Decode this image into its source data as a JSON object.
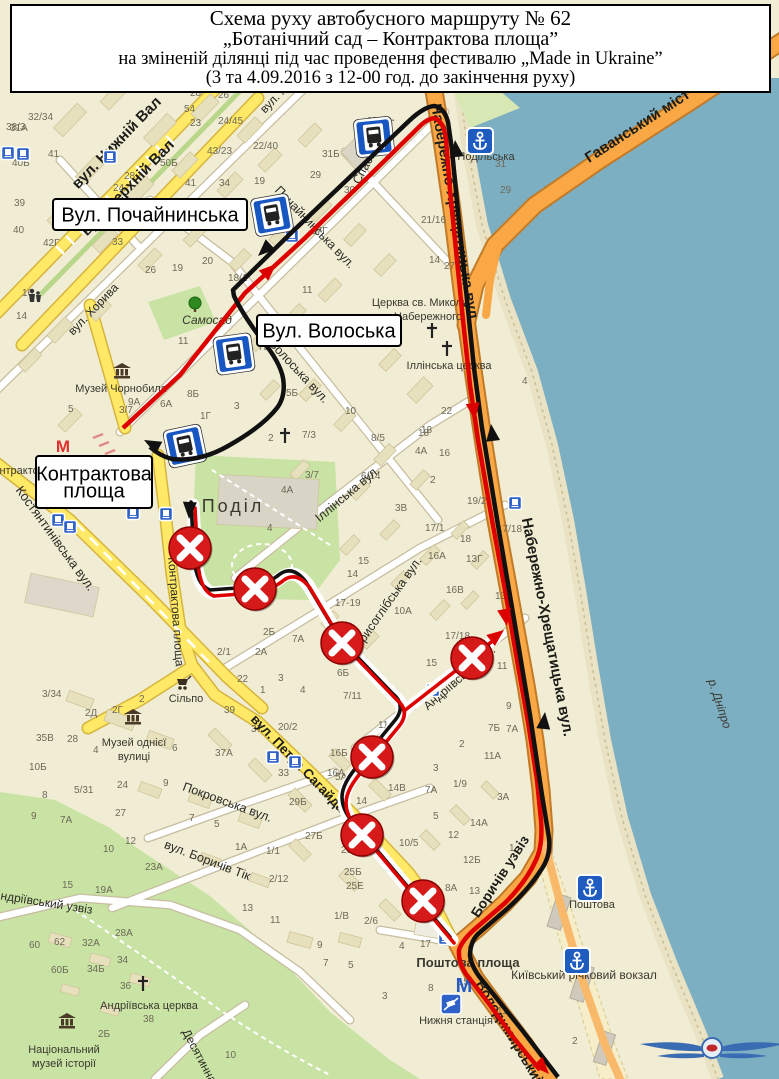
{
  "title": {
    "line1": "Схема руху автобусного маршруту № 62",
    "line2": "„Ботанічний сад – Контрактова площа”",
    "line3": "на зміненій ділянці під час проведення фестивалю „Made in Ukraine”",
    "line4": "(3 та 4.09.2016 з 12-00 год. до закінчення руху)"
  },
  "colors": {
    "land": "#f1edd4",
    "water": "#7dafc3",
    "quay": "#e9e2c4",
    "road_orange": "#f9a845",
    "road_orange_casing": "#c07a28",
    "road_yellow": "#ffe967",
    "road_yellow_casing": "#d5b43c",
    "road_white": "#ffffff",
    "road_white_casing": "#c6bd9f",
    "park": "#c9e3a4",
    "building": "#e7e0bd",
    "building_stroke": "#d0c59c",
    "route_red": "#dd0000",
    "route_black": "#111111",
    "sign_red": "#d61a1a",
    "stop_blue": "#1857c2",
    "blue_text": "#2a56ae"
  },
  "callouts": [
    {
      "id": "pochaininska",
      "x": 53,
      "y": 199,
      "w": 194,
      "h": 31,
      "lines": [
        "Вул. Почайнинська"
      ],
      "fs": 20
    },
    {
      "id": "voloska",
      "x": 257,
      "y": 315,
      "w": 144,
      "h": 31,
      "lines": [
        "Вул. Волоська"
      ],
      "fs": 20
    },
    {
      "id": "kontraktova",
      "x": 36,
      "y": 456,
      "w": 116,
      "h": 52,
      "lines": [
        "Контрактова",
        "площа"
      ],
      "fs": 20
    }
  ],
  "street_labels": [
    {
      "t": "вул. Нижній Вал",
      "x": 120,
      "y": 146,
      "r": -46,
      "s": 15,
      "b": 1
    },
    {
      "t": "вул. Верхній Вал",
      "x": 131,
      "y": 191,
      "r": -46,
      "s": 15,
      "b": 1
    },
    {
      "t": "вул. Хорива",
      "x": 96,
      "y": 312,
      "r": -46,
      "s": 12,
      "b": 0
    },
    {
      "t": "вул. Хорива",
      "x": 288,
      "y": 90,
      "r": -46,
      "s": 12,
      "b": 0
    },
    {
      "t": "Почайнинська вул.",
      "x": 312,
      "y": 230,
      "r": 46,
      "s": 12.5,
      "b": 0
    },
    {
      "t": "Спаська вул.",
      "x": 377,
      "y": 152,
      "r": -62,
      "s": 12.5,
      "b": 0
    },
    {
      "t": "Волоська вул.",
      "x": 296,
      "y": 374,
      "r": 47,
      "s": 12.5,
      "b": 0
    },
    {
      "t": "Костянтинівська вул.",
      "x": 52,
      "y": 541,
      "r": 54,
      "s": 13,
      "b": 0
    },
    {
      "t": "Іллінська вул.",
      "x": 350,
      "y": 497,
      "r": -40,
      "s": 12.5,
      "b": 0
    },
    {
      "t": "Борисоглібська вул.",
      "x": 389,
      "y": 608,
      "r": -55,
      "s": 12.5,
      "b": 0
    },
    {
      "t": "Андріївська вул.",
      "x": 462,
      "y": 681,
      "r": -41,
      "s": 12,
      "b": 0
    },
    {
      "t": "вул. Петра Сагайдачного",
      "x": 308,
      "y": 780,
      "r": 46,
      "s": 13.5,
      "b": 1
    },
    {
      "t": "Покровська вул.",
      "x": 226,
      "y": 806,
      "r": 20,
      "s": 12.5,
      "b": 0
    },
    {
      "t": "вул. Боричів Тік",
      "x": 206,
      "y": 864,
      "r": 21,
      "s": 12.5,
      "b": 0
    },
    {
      "t": "Андріївський узвіз",
      "x": 42,
      "y": 906,
      "r": 9,
      "s": 12,
      "b": 0
    },
    {
      "t": "Десятинна",
      "x": 196,
      "y": 1058,
      "r": 62,
      "s": 12,
      "b": 0
    },
    {
      "t": "Контрактова площа",
      "x": 172,
      "y": 612,
      "r": 86,
      "s": 12,
      "b": 0
    },
    {
      "t": "Набережно-Хрещатицька вул",
      "x": 450,
      "y": 212,
      "r": 80,
      "s": 15,
      "b": 1
    },
    {
      "t": "Набережно-Хрещатицька вул.",
      "x": 543,
      "y": 628,
      "r": 79,
      "s": 15,
      "b": 1
    },
    {
      "t": "Гаванський міст",
      "x": 640,
      "y": 130,
      "r": -33,
      "s": 15,
      "b": 1
    },
    {
      "t": "Боричів узвіз",
      "x": 504,
      "y": 879,
      "r": -57,
      "s": 14,
      "b": 1
    },
    {
      "t": "Володимирський узвіз",
      "x": 516,
      "y": 1052,
      "r": 59,
      "s": 14,
      "b": 1
    }
  ],
  "poi_labels": [
    {
      "t": "Музей Чорнобиля",
      "x": 121,
      "y": 392,
      "s": 11
    },
    {
      "t": "Самосад",
      "x": 207,
      "y": 324,
      "s": 12,
      "c": "#4f8f3f",
      "i": 1
    },
    {
      "t": "Поділ",
      "x": 233,
      "y": 512,
      "s": 18,
      "c": "#96927e",
      "ls": 3
    },
    {
      "t": "Церква св. Миколи",
      "x": 420,
      "y": 306,
      "s": 11
    },
    {
      "t": "Набережного",
      "x": 428,
      "y": 320,
      "s": 11
    },
    {
      "t": "Іллінська церква",
      "x": 449,
      "y": 369,
      "s": 11
    },
    {
      "t": "Музей однієї",
      "x": 134,
      "y": 746,
      "s": 11
    },
    {
      "t": "вулиці",
      "x": 134,
      "y": 760,
      "s": 11
    },
    {
      "t": "Сільпо",
      "x": 186,
      "y": 702,
      "s": 11
    },
    {
      "t": "Контрактова пл.",
      "x": 28,
      "y": 474,
      "s": 11,
      "c": "#55524a"
    },
    {
      "t": "Поштова площа",
      "x": 468,
      "y": 967,
      "s": 13,
      "b": 1
    },
    {
      "t": "Київський річковий вокзал",
      "x": 584,
      "y": 979,
      "s": 12,
      "c": "#2a56ae"
    },
    {
      "t": "Нижня станція",
      "x": 456,
      "y": 1024,
      "s": 11,
      "c": "#2a56ae"
    },
    {
      "t": "Поштова",
      "x": 592,
      "y": 908,
      "s": 11,
      "c": "#2a56ae"
    },
    {
      "t": "Подільська",
      "x": 486,
      "y": 160,
      "s": 11,
      "c": "#2a56ae"
    },
    {
      "t": "Андріївська церква",
      "x": 149,
      "y": 1009,
      "s": 11
    },
    {
      "t": "Національний",
      "x": 64,
      "y": 1053,
      "s": 11
    },
    {
      "t": "музей історії",
      "x": 64,
      "y": 1067,
      "s": 11
    },
    {
      "t": "р. Дніпро",
      "x": 716,
      "y": 705,
      "s": 12,
      "c": "#3b6fb4",
      "i": 1,
      "r": 72
    }
  ],
  "house_numbers": [
    {
      "x": 6,
      "y": 130,
      "t": "38/3"
    },
    {
      "x": 28,
      "y": 120,
      "t": "32/34"
    },
    {
      "x": 107,
      "y": 90,
      "t": "49"
    },
    {
      "x": 190,
      "y": 96,
      "t": "28"
    },
    {
      "x": 218,
      "y": 98,
      "t": "26"
    },
    {
      "x": 352,
      "y": 93,
      "t": "35А"
    },
    {
      "x": 10,
      "y": 131,
      "t": "31А"
    },
    {
      "x": 184,
      "y": 112,
      "t": "54"
    },
    {
      "x": 190,
      "y": 126,
      "t": "23"
    },
    {
      "x": 218,
      "y": 124,
      "t": "24/45"
    },
    {
      "x": 367,
      "y": 124,
      "t": "37"
    },
    {
      "x": 48,
      "y": 157,
      "t": "41"
    },
    {
      "x": 12,
      "y": 166,
      "t": "40Б"
    },
    {
      "x": 160,
      "y": 166,
      "t": "50Б"
    },
    {
      "x": 207,
      "y": 154,
      "t": "43/23"
    },
    {
      "x": 253,
      "y": 149,
      "t": "22/40"
    },
    {
      "x": 322,
      "y": 157,
      "t": "31Б"
    },
    {
      "x": 124,
      "y": 179,
      "t": "28"
    },
    {
      "x": 113,
      "y": 191,
      "t": "24"
    },
    {
      "x": 185,
      "y": 186,
      "t": "41"
    },
    {
      "x": 219,
      "y": 186,
      "t": "34"
    },
    {
      "x": 254,
      "y": 184,
      "t": "19"
    },
    {
      "x": 14,
      "y": 206,
      "t": "39"
    },
    {
      "x": 310,
      "y": 178,
      "t": "29"
    },
    {
      "x": 344,
      "y": 193,
      "t": "30"
    },
    {
      "x": 13,
      "y": 233,
      "t": "40"
    },
    {
      "x": 43,
      "y": 246,
      "t": "42Г"
    },
    {
      "x": 22,
      "y": 296,
      "t": "16"
    },
    {
      "x": 16,
      "y": 319,
      "t": "14"
    },
    {
      "x": 145,
      "y": 273,
      "t": "26"
    },
    {
      "x": 172,
      "y": 271,
      "t": "19"
    },
    {
      "x": 202,
      "y": 264,
      "t": "20"
    },
    {
      "x": 112,
      "y": 245,
      "t": "33"
    },
    {
      "x": 228,
      "y": 281,
      "t": "18/1"
    },
    {
      "x": 311,
      "y": 234,
      "t": "17Г"
    },
    {
      "x": 302,
      "y": 293,
      "t": "11"
    },
    {
      "x": 217,
      "y": 352,
      "t": "12"
    },
    {
      "x": 178,
      "y": 344,
      "t": "11"
    },
    {
      "x": 215,
      "y": 371,
      "t": "10"
    },
    {
      "x": 258,
      "y": 350,
      "t": "7Б"
    },
    {
      "x": 286,
      "y": 396,
      "t": "5Б"
    },
    {
      "x": 234,
      "y": 409,
      "t": "3"
    },
    {
      "x": 128,
      "y": 405,
      "t": "9А"
    },
    {
      "x": 187,
      "y": 397,
      "t": "8Б"
    },
    {
      "x": 160,
      "y": 407,
      "t": "6А"
    },
    {
      "x": 200,
      "y": 419,
      "t": "1Г"
    },
    {
      "x": 119,
      "y": 413,
      "t": "3/7"
    },
    {
      "x": 68,
      "y": 412,
      "t": "5"
    },
    {
      "x": 302,
      "y": 438,
      "t": "7/3"
    },
    {
      "x": 268,
      "y": 441,
      "t": "2"
    },
    {
      "x": 371,
      "y": 441,
      "t": "8/5"
    },
    {
      "x": 345,
      "y": 414,
      "t": "10"
    },
    {
      "x": 305,
      "y": 478,
      "t": "3/7"
    },
    {
      "x": 281,
      "y": 493,
      "t": "4А"
    },
    {
      "x": 267,
      "y": 531,
      "t": "4"
    },
    {
      "x": 361,
      "y": 479,
      "t": "6/14"
    },
    {
      "x": 421,
      "y": 433,
      "t": "18"
    },
    {
      "x": 415,
      "y": 454,
      "t": "4А"
    },
    {
      "x": 439,
      "y": 456,
      "t": "16"
    },
    {
      "x": 430,
      "y": 483,
      "t": "2"
    },
    {
      "x": 395,
      "y": 511,
      "t": "3В"
    },
    {
      "x": 425,
      "y": 531,
      "t": "17/1"
    },
    {
      "x": 428,
      "y": 559,
      "t": "16А"
    },
    {
      "x": 466,
      "y": 562,
      "t": "13Г"
    },
    {
      "x": 446,
      "y": 593,
      "t": "16В"
    },
    {
      "x": 495,
      "y": 599,
      "t": "13Б"
    },
    {
      "x": 467,
      "y": 504,
      "t": "19/21"
    },
    {
      "x": 497,
      "y": 532,
      "t": "17/18"
    },
    {
      "x": 460,
      "y": 542,
      "t": "18"
    },
    {
      "x": 358,
      "y": 564,
      "t": "15"
    },
    {
      "x": 347,
      "y": 577,
      "t": "14"
    },
    {
      "x": 335,
      "y": 606,
      "t": "17-19"
    },
    {
      "x": 394,
      "y": 614,
      "t": "10А"
    },
    {
      "x": 445,
      "y": 639,
      "t": "17/18"
    },
    {
      "x": 426,
      "y": 666,
      "t": "15"
    },
    {
      "x": 497,
      "y": 669,
      "t": "11"
    },
    {
      "x": 506,
      "y": 709,
      "t": "9"
    },
    {
      "x": 488,
      "y": 731,
      "t": "7Б"
    },
    {
      "x": 506,
      "y": 732,
      "t": "7А"
    },
    {
      "x": 337,
      "y": 676,
      "t": "6Б"
    },
    {
      "x": 343,
      "y": 699,
      "t": "7/11"
    },
    {
      "x": 378,
      "y": 728,
      "t": "11А"
    },
    {
      "x": 335,
      "y": 780,
      "t": "5А"
    },
    {
      "x": 388,
      "y": 791,
      "t": "14В"
    },
    {
      "x": 425,
      "y": 793,
      "t": "7А"
    },
    {
      "x": 459,
      "y": 747,
      "t": "2"
    },
    {
      "x": 484,
      "y": 759,
      "t": "11А"
    },
    {
      "x": 433,
      "y": 771,
      "t": "3"
    },
    {
      "x": 453,
      "y": 787,
      "t": "1/9"
    },
    {
      "x": 497,
      "y": 800,
      "t": "3А"
    },
    {
      "x": 433,
      "y": 819,
      "t": "5"
    },
    {
      "x": 356,
      "y": 804,
      "t": "14"
    },
    {
      "x": 348,
      "y": 822,
      "t": "10"
    },
    {
      "x": 470,
      "y": 826,
      "t": "14А"
    },
    {
      "x": 448,
      "y": 838,
      "t": "12"
    },
    {
      "x": 399,
      "y": 846,
      "t": "10/5"
    },
    {
      "x": 463,
      "y": 863,
      "t": "12Б"
    },
    {
      "x": 509,
      "y": 851,
      "t": "1"
    },
    {
      "x": 341,
      "y": 853,
      "t": "25А"
    },
    {
      "x": 344,
      "y": 875,
      "t": "25Б"
    },
    {
      "x": 346,
      "y": 889,
      "t": "25Е"
    },
    {
      "x": 407,
      "y": 911,
      "t": "23"
    },
    {
      "x": 445,
      "y": 891,
      "t": "8А"
    },
    {
      "x": 469,
      "y": 894,
      "t": "13"
    },
    {
      "x": 420,
      "y": 947,
      "t": "17"
    },
    {
      "x": 399,
      "y": 949,
      "t": "4"
    },
    {
      "x": 364,
      "y": 924,
      "t": "2/6"
    },
    {
      "x": 334,
      "y": 919,
      "t": "1/В"
    },
    {
      "x": 458,
      "y": 985,
      "t": "15"
    },
    {
      "x": 428,
      "y": 991,
      "t": "8"
    },
    {
      "x": 497,
      "y": 1014,
      "t": "11"
    },
    {
      "x": 572,
      "y": 1044,
      "t": "2"
    },
    {
      "x": 42,
      "y": 697,
      "t": "3/34"
    },
    {
      "x": 85,
      "y": 716,
      "t": "2Д"
    },
    {
      "x": 112,
      "y": 713,
      "t": "2Г"
    },
    {
      "x": 139,
      "y": 702,
      "t": "2"
    },
    {
      "x": 36,
      "y": 741,
      "t": "35В"
    },
    {
      "x": 67,
      "y": 742,
      "t": "28"
    },
    {
      "x": 93,
      "y": 753,
      "t": "4"
    },
    {
      "x": 172,
      "y": 751,
      "t": "6"
    },
    {
      "x": 215,
      "y": 756,
      "t": "37А"
    },
    {
      "x": 224,
      "y": 713,
      "t": "39"
    },
    {
      "x": 251,
      "y": 732,
      "t": "37"
    },
    {
      "x": 278,
      "y": 730,
      "t": "20/2"
    },
    {
      "x": 278,
      "y": 776,
      "t": "33"
    },
    {
      "x": 289,
      "y": 805,
      "t": "29Б"
    },
    {
      "x": 330,
      "y": 756,
      "t": "16Б"
    },
    {
      "x": 327,
      "y": 776,
      "t": "16А"
    },
    {
      "x": 305,
      "y": 839,
      "t": "27Б"
    },
    {
      "x": 29,
      "y": 770,
      "t": "10Б"
    },
    {
      "x": 42,
      "y": 798,
      "t": "8"
    },
    {
      "x": 74,
      "y": 793,
      "t": "5/31"
    },
    {
      "x": 117,
      "y": 788,
      "t": "24"
    },
    {
      "x": 163,
      "y": 786,
      "t": "9"
    },
    {
      "x": 115,
      "y": 816,
      "t": "27"
    },
    {
      "x": 125,
      "y": 844,
      "t": "12"
    },
    {
      "x": 103,
      "y": 852,
      "t": "10"
    },
    {
      "x": 60,
      "y": 823,
      "t": "7А"
    },
    {
      "x": 31,
      "y": 819,
      "t": "9"
    },
    {
      "x": 145,
      "y": 870,
      "t": "23А"
    },
    {
      "x": 189,
      "y": 821,
      "t": "7"
    },
    {
      "x": 214,
      "y": 827,
      "t": "5"
    },
    {
      "x": 235,
      "y": 850,
      "t": "1А"
    },
    {
      "x": 266,
      "y": 854,
      "t": "1/1"
    },
    {
      "x": 269,
      "y": 882,
      "t": "2/12"
    },
    {
      "x": 242,
      "y": 911,
      "t": "13"
    },
    {
      "x": 270,
      "y": 923,
      "t": "11"
    },
    {
      "x": 62,
      "y": 888,
      "t": "15"
    },
    {
      "x": 95,
      "y": 893,
      "t": "19А"
    },
    {
      "x": 115,
      "y": 936,
      "t": "28А"
    },
    {
      "x": 82,
      "y": 946,
      "t": "32А"
    },
    {
      "x": 54,
      "y": 945,
      "t": "62"
    },
    {
      "x": 29,
      "y": 948,
      "t": "60"
    },
    {
      "x": 117,
      "y": 963,
      "t": "34"
    },
    {
      "x": 51,
      "y": 973,
      "t": "60Б"
    },
    {
      "x": 87,
      "y": 972,
      "t": "34Б"
    },
    {
      "x": 120,
      "y": 989,
      "t": "36"
    },
    {
      "x": 143,
      "y": 1022,
      "t": "38"
    },
    {
      "x": 98,
      "y": 1037,
      "t": "2Б"
    },
    {
      "x": 225,
      "y": 1058,
      "t": "10"
    },
    {
      "x": 317,
      "y": 948,
      "t": "9"
    },
    {
      "x": 323,
      "y": 966,
      "t": "7"
    },
    {
      "x": 348,
      "y": 968,
      "t": "5"
    },
    {
      "x": 382,
      "y": 999,
      "t": "3"
    },
    {
      "x": 495,
      "y": 167,
      "t": "31"
    },
    {
      "x": 500,
      "y": 193,
      "t": "29"
    },
    {
      "x": 421,
      "y": 223,
      "t": "21/16"
    },
    {
      "x": 429,
      "y": 263,
      "t": "14"
    },
    {
      "x": 444,
      "y": 269,
      "t": "27"
    },
    {
      "x": 522,
      "y": 384,
      "t": "4"
    },
    {
      "x": 441,
      "y": 414,
      "t": "22"
    },
    {
      "x": 418,
      "y": 436,
      "t": "18"
    },
    {
      "x": 263,
      "y": 635,
      "t": "2Б"
    },
    {
      "x": 292,
      "y": 642,
      "t": "7А"
    },
    {
      "x": 217,
      "y": 655,
      "t": "2/1"
    },
    {
      "x": 255,
      "y": 655,
      "t": "2А"
    },
    {
      "x": 237,
      "y": 682,
      "t": "22"
    },
    {
      "x": 260,
      "y": 693,
      "t": "1"
    },
    {
      "x": 278,
      "y": 681,
      "t": "3"
    },
    {
      "x": 300,
      "y": 693,
      "t": "4"
    }
  ],
  "prohibition_signs": [
    {
      "x": 190,
      "y": 548
    },
    {
      "x": 255,
      "y": 589
    },
    {
      "x": 342,
      "y": 643
    },
    {
      "x": 472,
      "y": 658
    },
    {
      "x": 372,
      "y": 757
    },
    {
      "x": 362,
      "y": 835
    },
    {
      "x": 423,
      "y": 901
    }
  ],
  "arrows": {
    "red": [
      {
        "x": 276,
        "y": 264,
        "r": -43
      },
      {
        "x": 475,
        "y": 420,
        "r": 82
      },
      {
        "x": 507,
        "y": 626,
        "r": 80
      },
      {
        "x": 549,
        "y": 1074,
        "r": 47
      },
      {
        "x": 504,
        "y": 630,
        "r": -38
      }
    ],
    "black": [
      {
        "x": 258,
        "y": 256,
        "r": 137
      },
      {
        "x": 455,
        "y": 140,
        "r": -96
      },
      {
        "x": 491,
        "y": 424,
        "r": -97
      },
      {
        "x": 545,
        "y": 712,
        "r": -84
      },
      {
        "x": 144,
        "y": 440,
        "r": -152
      },
      {
        "x": 189,
        "y": 519,
        "r": 93
      }
    ]
  },
  "bus_stop_signs": [
    {
      "x": 272,
      "y": 215,
      "r": -10
    },
    {
      "x": 234,
      "y": 354,
      "r": -8
    },
    {
      "x": 185,
      "y": 446,
      "r": -12
    },
    {
      "x": 374,
      "y": 137,
      "r": -6
    }
  ],
  "small_stops": [
    {
      "x": 8,
      "y": 153
    },
    {
      "x": 23,
      "y": 154
    },
    {
      "x": 110,
      "y": 157
    },
    {
      "x": 58,
      "y": 520
    },
    {
      "x": 70,
      "y": 527
    },
    {
      "x": 133,
      "y": 513
    },
    {
      "x": 166,
      "y": 514
    },
    {
      "x": 515,
      "y": 503
    },
    {
      "x": 273,
      "y": 757
    },
    {
      "x": 295,
      "y": 762
    },
    {
      "x": 445,
      "y": 938
    },
    {
      "x": 433,
      "y": 690
    },
    {
      "x": 292,
      "y": 236
    }
  ],
  "anchors": [
    {
      "x": 480,
      "y": 141
    },
    {
      "x": 590,
      "y": 888
    },
    {
      "x": 577,
      "y": 961
    }
  ],
  "metro": [
    {
      "x": 63,
      "y": 452,
      "c": "#e03030",
      "s": 17
    },
    {
      "x": 464,
      "y": 992,
      "c": "#2459c4",
      "s": 20
    }
  ],
  "museums": [
    {
      "x": 122,
      "y": 371
    },
    {
      "x": 133,
      "y": 717
    },
    {
      "x": 67,
      "y": 1021
    }
  ],
  "crosses": [
    {
      "x": 285,
      "y": 436
    },
    {
      "x": 447,
      "y": 349
    },
    {
      "x": 143,
      "y": 984
    },
    {
      "x": 432,
      "y": 331
    }
  ],
  "misc_icons": {
    "cart": {
      "x": 183,
      "y": 683
    },
    "tree": {
      "x": 195,
      "y": 306
    },
    "persons": {
      "x": 35,
      "y": 297
    },
    "funicular": {
      "x": 451,
      "y": 1004
    }
  }
}
